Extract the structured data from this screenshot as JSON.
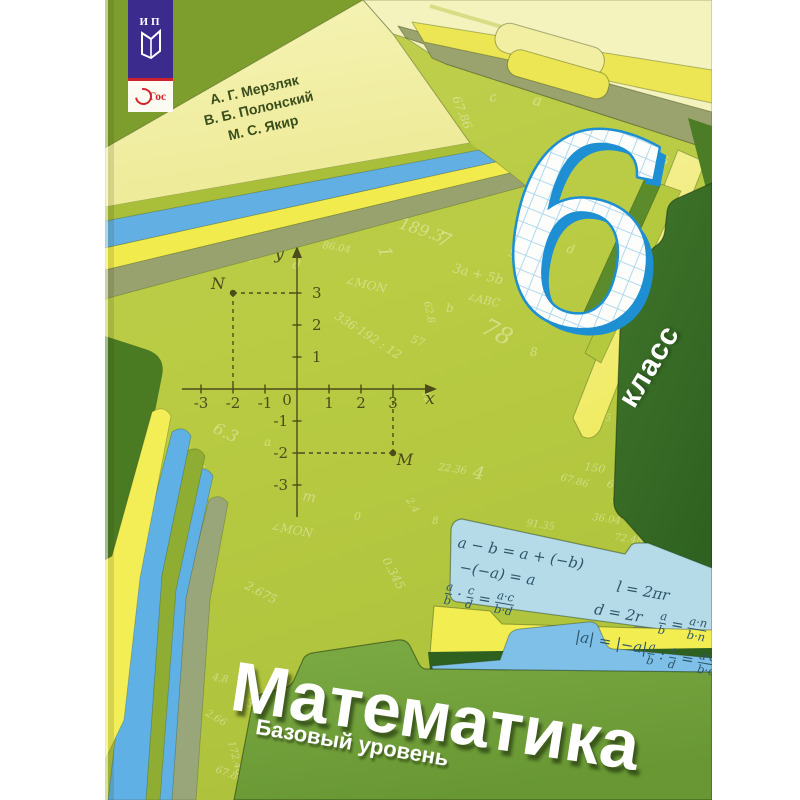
{
  "page": {
    "type": "book-cover-photo",
    "background": "#ffffff"
  },
  "publisher_badge": {
    "letters": "ИП"
  },
  "fgos_badge": {
    "label": "ФГОС",
    "ring_text": "Гос"
  },
  "authors": [
    "А. Г. Мерзляк",
    "В. Б. Полонский",
    "М. С. Якир"
  ],
  "grade": {
    "number": "6",
    "label": "класс"
  },
  "title": "Математика",
  "subtitle": "Базовый уровень",
  "colors": {
    "cover_green": "#b8cb42",
    "dark_wedge_green": "#7d9e2c",
    "klass_folder_green": "#3a6d28",
    "title_folder_green": "#74a83c",
    "card_blue": "#b5dbe9",
    "digit_outline_blue": "#1d8fd2",
    "banner_purple": "#3a2b8d",
    "fgos_red": "#d3232a",
    "accent_yellow": "#f2ee52",
    "accent_sky": "#62afe3"
  },
  "formula_card": {
    "formulas": [
      {
        "x": 8,
        "y": 2,
        "f": "a − b = a + (−b)"
      },
      {
        "x": 14,
        "y": 26,
        "f": "−(−a) = a"
      },
      {
        "x": 4,
        "y": 50,
        "f": "[a/b] · [c/d] = [a·c/b·d]"
      },
      {
        "x": 172,
        "y": 18,
        "f": "l = 2πr"
      },
      {
        "x": 154,
        "y": 44,
        "f": "d = 2r"
      },
      {
        "x": 140,
        "y": 74,
        "f": "|a| = |−a|"
      },
      {
        "x": 220,
        "y": 42,
        "f": "[a/b] = [a·n/b·n]"
      },
      {
        "x": 214,
        "y": 74,
        "f": "[a/b] : [c/d] = [a·d/b·c]"
      }
    ]
  },
  "coordinate_plane": {
    "x_label": "x",
    "y_label": "y",
    "origin_label": "0",
    "x_ticks": [
      -3,
      -2,
      -1,
      1,
      2,
      3
    ],
    "y_ticks": [
      -3,
      -2,
      -1,
      1,
      2,
      3
    ],
    "points": [
      {
        "name": "N",
        "x": -2,
        "y": 3
      },
      {
        "name": "M",
        "x": 3,
        "y": -2
      }
    ]
  },
  "background_symbols": [
    [
      "189.3",
      398,
      228,
      18,
      16
    ],
    [
      "86.04",
      322,
      248,
      10,
      10
    ],
    [
      "∠MON",
      344,
      284,
      12,
      12
    ],
    [
      "3a + 5b",
      452,
      272,
      14,
      13
    ],
    [
      "∠ABC",
      466,
      300,
      12,
      11
    ],
    [
      "336·192 : 12",
      334,
      318,
      33,
      12
    ],
    [
      "62.8",
      424,
      302,
      78,
      10
    ],
    [
      "57",
      410,
      342,
      20,
      11
    ],
    [
      "78",
      480,
      332,
      28,
      24
    ],
    [
      "a",
      532,
      104,
      15,
      15
    ],
    [
      "c",
      490,
      102,
      -10,
      13
    ],
    [
      "67.86",
      452,
      98,
      68,
      12
    ],
    [
      "175",
      666,
      96,
      28,
      15
    ],
    [
      "178.2",
      632,
      112,
      10,
      10
    ],
    [
      "p",
      684,
      114,
      20,
      14
    ],
    [
      "545",
      646,
      156,
      25,
      12
    ],
    [
      "231",
      484,
      188,
      8,
      12
    ],
    [
      "3.7",
      444,
      176,
      0,
      10
    ],
    [
      "m",
      472,
      170,
      12,
      17
    ],
    [
      "59",
      526,
      306,
      6,
      12
    ],
    [
      "0.345",
      382,
      560,
      62,
      12
    ],
    [
      "2.675",
      244,
      588,
      28,
      12
    ],
    [
      "6.3",
      212,
      432,
      25,
      16
    ],
    [
      "∠MON",
      270,
      530,
      10,
      12
    ],
    [
      "22.36",
      438,
      470,
      8,
      10
    ],
    [
      "150",
      584,
      470,
      8,
      11
    ],
    [
      "67.88",
      606,
      486,
      25,
      11
    ],
    [
      "91.35",
      526,
      526,
      8,
      10
    ],
    [
      "36.04",
      592,
      520,
      8,
      10
    ],
    [
      "72.48",
      614,
      540,
      8,
      10
    ],
    [
      "4",
      472,
      478,
      10,
      18
    ],
    [
      "12",
      422,
      392,
      70,
      10
    ],
    [
      "ABC",
      116,
      276,
      8,
      11
    ],
    [
      "3 М",
      612,
      502,
      8,
      9
    ],
    [
      "q",
      514,
      228,
      10,
      13
    ],
    [
      "5",
      508,
      256,
      15,
      12
    ],
    [
      "7",
      436,
      244,
      20,
      20
    ],
    [
      "1",
      378,
      248,
      75,
      18
    ],
    [
      "125",
      592,
      418,
      10,
      10
    ],
    [
      "149°",
      654,
      572,
      15,
      9
    ],
    [
      "8",
      530,
      356,
      0,
      12
    ],
    [
      "s",
      198,
      470,
      20,
      12
    ],
    [
      "a",
      264,
      446,
      0,
      12
    ],
    [
      "0",
      354,
      520,
      0,
      11
    ],
    [
      "2.4",
      406,
      500,
      60,
      10
    ],
    [
      "8",
      432,
      524,
      0,
      10
    ],
    [
      "m",
      302,
      500,
      10,
      14
    ],
    [
      "c",
      248,
      262,
      -15,
      12
    ],
    [
      "d",
      292,
      268,
      10,
      12
    ],
    [
      "b",
      446,
      312,
      0,
      12
    ],
    [
      "67.86",
      560,
      480,
      15,
      10
    ],
    [
      "d",
      566,
      252,
      15,
      12
    ],
    [
      "172.48",
      228,
      742,
      75,
      10
    ],
    [
      "67.86",
      215,
      772,
      20,
      10
    ],
    [
      "230",
      240,
      705,
      10,
      10
    ],
    [
      "2.66",
      205,
      715,
      30,
      10
    ],
    [
      "4.8",
      212,
      680,
      10,
      10
    ],
    [
      "7",
      250,
      745,
      15,
      16
    ]
  ]
}
